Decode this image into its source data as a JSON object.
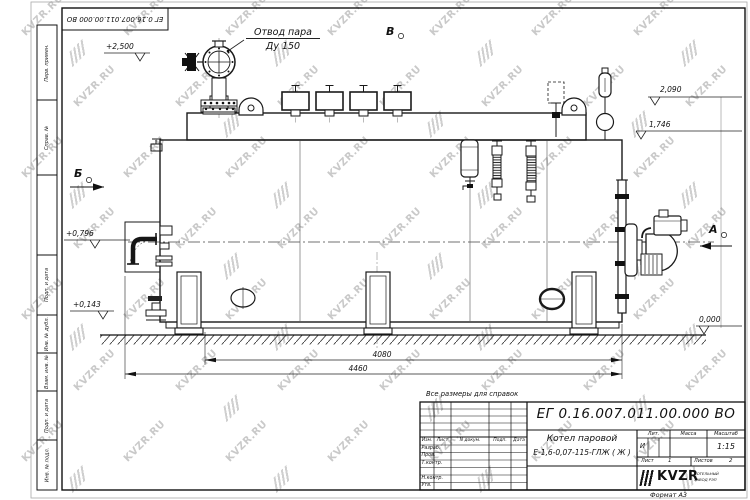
{
  "watermark": {
    "text": "KVZR.RU"
  },
  "frame": {
    "top_doc_number": "ЕГ 0.16.007.011.00.000  ВО",
    "side_labels": [
      "Перв. примен.",
      "Справ. №",
      "",
      "Подп. и дата",
      "Инв. № дубл.",
      "Взам. инв. №",
      "Подп. и дата",
      "Инв. № подл."
    ],
    "format_note": "Формат А3"
  },
  "drawing": {
    "callout_steam_line1": "Отвод пара",
    "callout_steam_line2": "Ду 150",
    "views": {
      "a": "А",
      "b": "Б",
      "v": "В"
    },
    "elevations": {
      "e2500": "+2,500",
      "e2090": "2,090",
      "e1746": "1,746",
      "e0796": "+0,796",
      "e0143": "+0,143",
      "e0000": "0,000"
    },
    "dimensions": {
      "d4080": "4080",
      "d4460": "4460"
    }
  },
  "title_block": {
    "reference_note": "Все размеры для справок",
    "doc_number": "ЕГ 0.16.007.011.00.000  ВО",
    "product_line1": "Котел паровой",
    "product_line2": "Е-1,6-0,07-115-ГЛЖ ( Ж )",
    "cols": {
      "izm": "Изм.",
      "list": "Лист",
      "ndoc": "N докум.",
      "podp": "Подп.",
      "data": "Дата"
    },
    "rows": {
      "razrab": "Разраб.",
      "prov": "Пров.",
      "tkontr": "Т.контр.",
      "nkontr": "Н.контр.",
      "utv": "Утв."
    },
    "lit_label": "Лит.",
    "mass_label": "Масса",
    "scale_label": "Масштаб",
    "lit_value": "И",
    "scale_value": "1:15",
    "sheet_label": "Лист",
    "sheet_value": "1",
    "sheets_label": "Листов",
    "sheets_value": "2",
    "logo_text": "KVZR",
    "logo_tagline1": "КОТЕЛЬНЫЙ",
    "logo_tagline2": "ЗАВОД РЭП"
  }
}
